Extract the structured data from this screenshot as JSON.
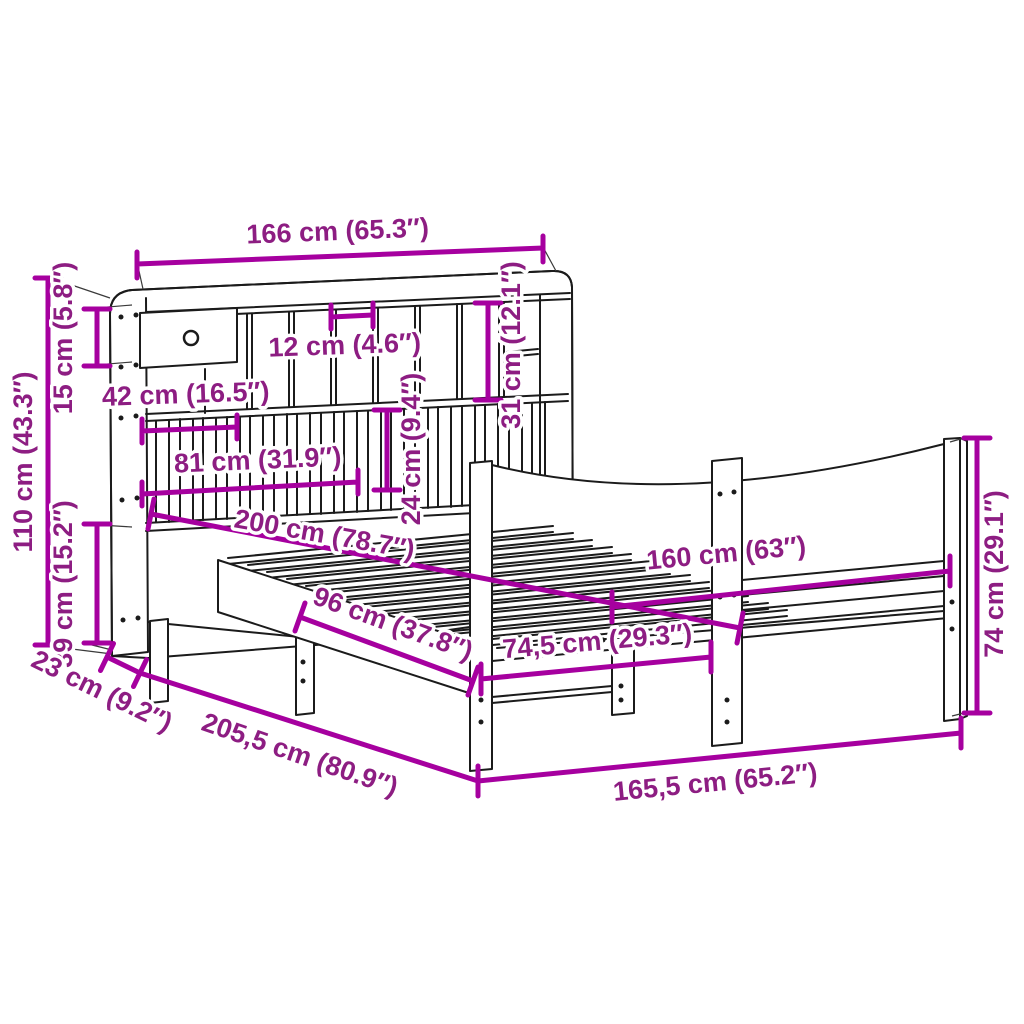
{
  "diagram_type": "furniture dimension drawing",
  "product": "bookcase bed frame with headboard shelves and curved footboard",
  "colors": {
    "dimension_line": "#A6009F",
    "dimension_text": "#8D1D82",
    "outline": "#1B1B1B",
    "background": "#FFFFFF"
  },
  "dimensions": {
    "headboard_width": "166 cm (65.3″)",
    "headboard_height": "110 cm (43.3″)",
    "top_shelf_height": "15 cm (5.8″)",
    "rail_floor_height": "39 cm (15.2″)",
    "headboard_depth": "23 cm (9.2″)",
    "total_length": "205,5 cm (80.9″)",
    "total_width": "165,5 cm (65.2″)",
    "footboard_height": "74 cm (29.1″)",
    "mattress_width": "160 cm (63″)",
    "mattress_length": "200 cm (78.7″)",
    "under_bed_clearance_length": "96 cm (37.8″)",
    "foot_section_width": "74,5 cm (29.3″)",
    "cubby_width": "12 cm (4.6″)",
    "drawer_width": "42 cm (16.5″)",
    "slat_panel_width": "81 cm (31.9″)",
    "slat_panel_height": "24 cm (9.4″)",
    "cubby_height": "31 cm (12.1″)"
  }
}
